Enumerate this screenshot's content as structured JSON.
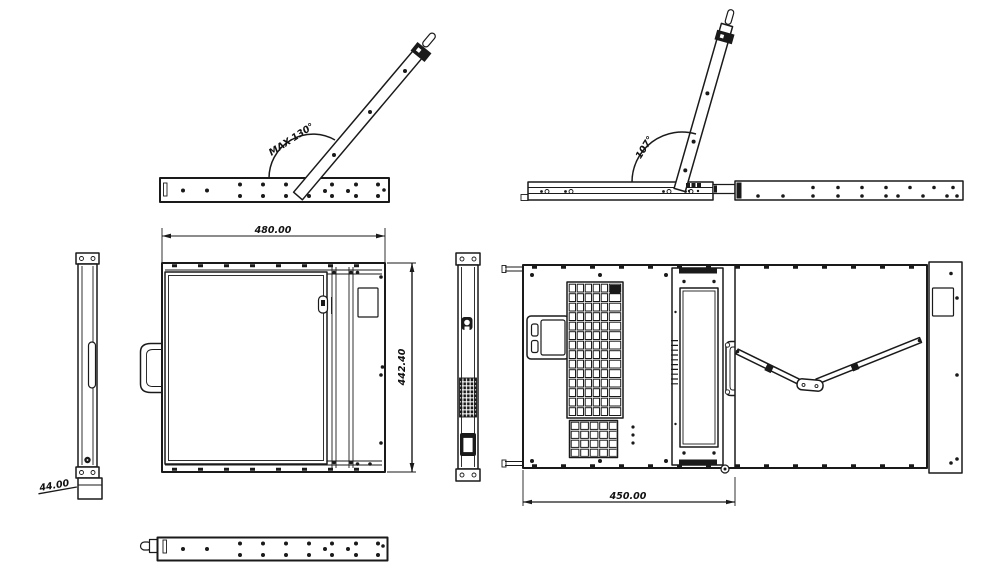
{
  "drawing": {
    "background": "#ffffff",
    "line_color": "#1a1a1a",
    "labels": {
      "max_open_angle": "MAX-130°",
      "open_angle": "107°",
      "width_mm": "480.00",
      "depth_mm": "442.40",
      "height_mm": "44.00",
      "inner_depth_mm": "450.00"
    }
  }
}
